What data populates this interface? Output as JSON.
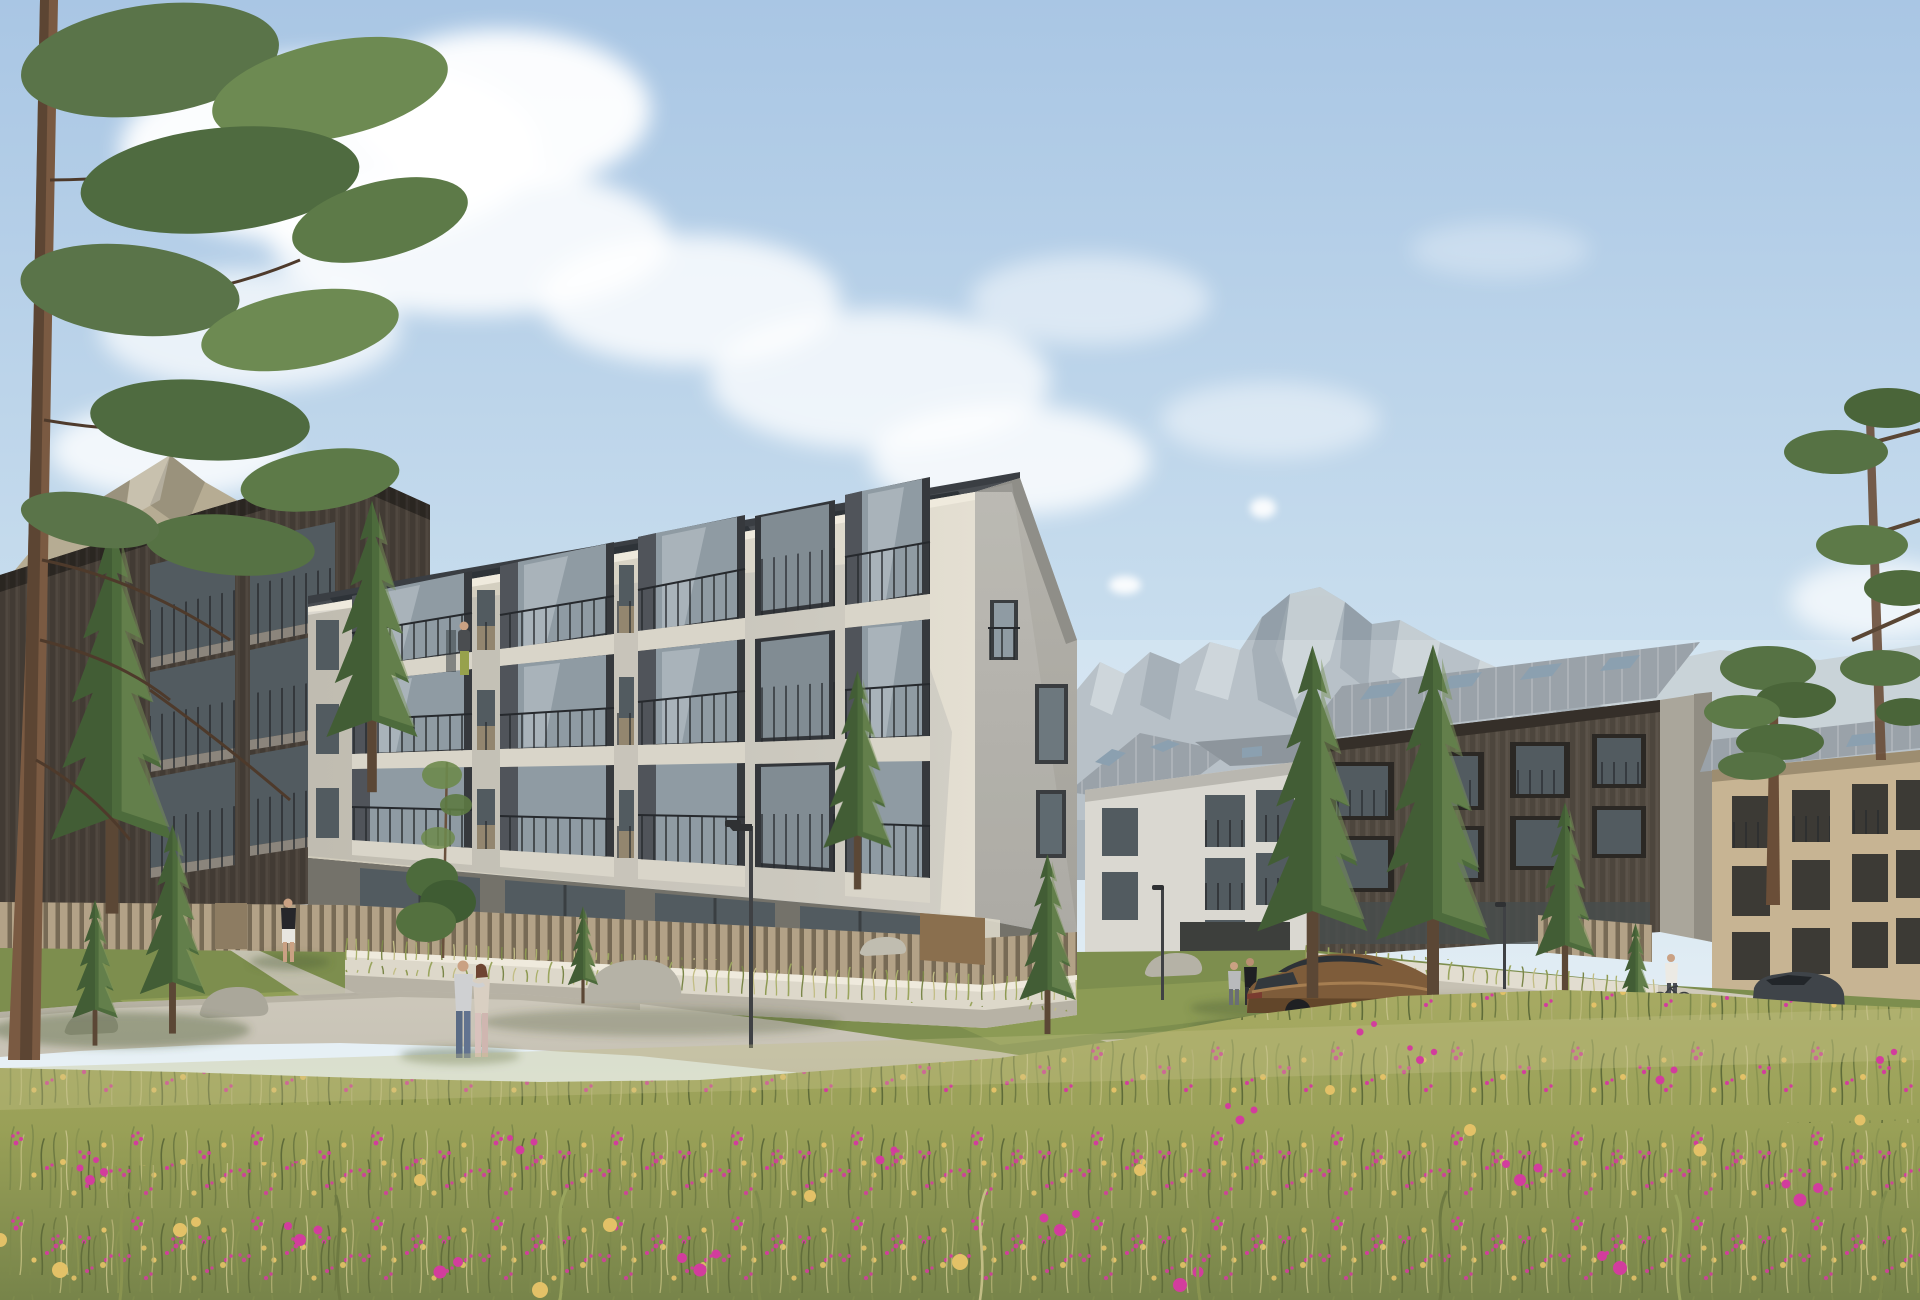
{
  "meta": {
    "title": "Alpine residential complex — exterior architectural visualization",
    "format": "photorealistic 3D rendering",
    "canvas": "1920x1300"
  },
  "palette": {
    "sky_top": "#a9c6e4",
    "sky_mid": "#c9deee",
    "sky_horizon": "#eaf2f6",
    "cloud": "#ffffff",
    "mountain_left_lit": "#b6ac93",
    "mountain_left_shadow": "#8f8873",
    "mountain_lit": "#c9d2d7",
    "mountain_base": "#a9b4bc",
    "mountain_shadow": "#8b97a1",
    "mountain_far": "#bcc7ce",
    "facade_lit": "#ddd8cb",
    "facade_shade": "#c6c2b5",
    "gable": "#b5b3ac",
    "roof_dark": "#494d52",
    "solar_panel": "#2e3338",
    "balcony_frame": "#36393d",
    "balcony_jamb": "#50545a",
    "glass_sky": "#8f9ba3",
    "glass_dark": "#525b60",
    "railing": "#26292d",
    "concrete_slab": "#d9d5c9",
    "plinth": "#74726a",
    "wall_concrete": "#ddd8ca",
    "fence_wood": "#b3a287",
    "panel_tan": "#93866f",
    "wood_dark_building": "#4a423a",
    "wood_east_building": "#564e44",
    "wood_beige_building": "#c7b493",
    "white_building": "#dad8d1",
    "roof_metal": "#9aa2a9",
    "skylight": "#8ba0b0",
    "lawn": "#7d8e4e",
    "lawn_light": "#9aa75c",
    "meadow_base": "#99a057",
    "grass_dry": "#bcb987",
    "flower_pink": "#d23d9d",
    "flower_yellow": "#e3c167",
    "path": "#c4bfb2",
    "rock": "#b5b2a6",
    "trunk_pine": "#7a5a42",
    "conifer": "#4d6b3c",
    "conifer_dark": "#3a5230",
    "conifer_light": "#79945a",
    "car_bronze": "#7e5c3a",
    "car_glass": "#2d3237",
    "car_dark": "#3f4449"
  },
  "scene": {
    "environment": {
      "setting": "alpine valley, sunny day",
      "sky": "light blue with scattered cumulus clouds",
      "mountains": [
        "rocky peak at far left behind pines",
        "large central granite massif",
        "hazy ridge behind east buildings"
      ]
    },
    "buildings": [
      {
        "id": "west-wing",
        "material": "dark timber cladding",
        "floors": 4,
        "features": [
          "angled balcony bays",
          "slat fence at garden"
        ]
      },
      {
        "id": "main-block",
        "material": "light grey stucco",
        "floors": 4,
        "features": [
          "four columns of angled dark balcony bays",
          "narrow french windows with timber infill panels",
          "mono-pitch roof with solar panels",
          "glazed ground floor",
          "timber slat fence on concrete plinth",
          "shaded gable end with small windows"
        ]
      },
      {
        "id": "courtyard-block",
        "material": "white render",
        "floors": 3,
        "features": [
          "gabled standing-seam roof",
          "roof windows"
        ]
      },
      {
        "id": "east-block",
        "material": "dark timber cladding",
        "floors": 4,
        "features": [
          "standing-seam metal roof with skylights",
          "full-height glazing",
          "concrete gable wall"
        ]
      },
      {
        "id": "far-east-block",
        "material": "pale larch cladding",
        "floors": 4,
        "features": [
          "standing-seam roof",
          "recessed balconies"
        ]
      }
    ],
    "vegetation": {
      "conifers": 11,
      "pines": 3,
      "meadow": "foreground wildflower meadow with magenta catchfly and pale yellow daisies",
      "other": "wild grasses along fences, low shrubs, young sapling by footpath"
    },
    "people": [
      {
        "id": "balcony-resident",
        "where": "top-floor balcony of main block",
        "count": 2
      },
      {
        "id": "walking-couple",
        "where": "footpath in front of main block",
        "count": 2
      },
      {
        "id": "man-at-fence",
        "where": "garden fence of west wing",
        "count": 1
      },
      {
        "id": "two-men-talking",
        "where": "lawn beside parked car",
        "count": 2
      },
      {
        "id": "cyclist",
        "where": "path along east retaining wall",
        "count": 1
      }
    ],
    "vehicles": [
      {
        "id": "bronze-fastback",
        "color": "metallic bronze",
        "where": "parked on courtyard apron"
      },
      {
        "id": "graphite-car",
        "color": "dark grey",
        "where": "parked at far right"
      }
    ],
    "street_furniture": {
      "lampposts": 3,
      "retaining_walls": "light concrete",
      "fences": "vertical larch slats",
      "boulders": 4
    }
  }
}
